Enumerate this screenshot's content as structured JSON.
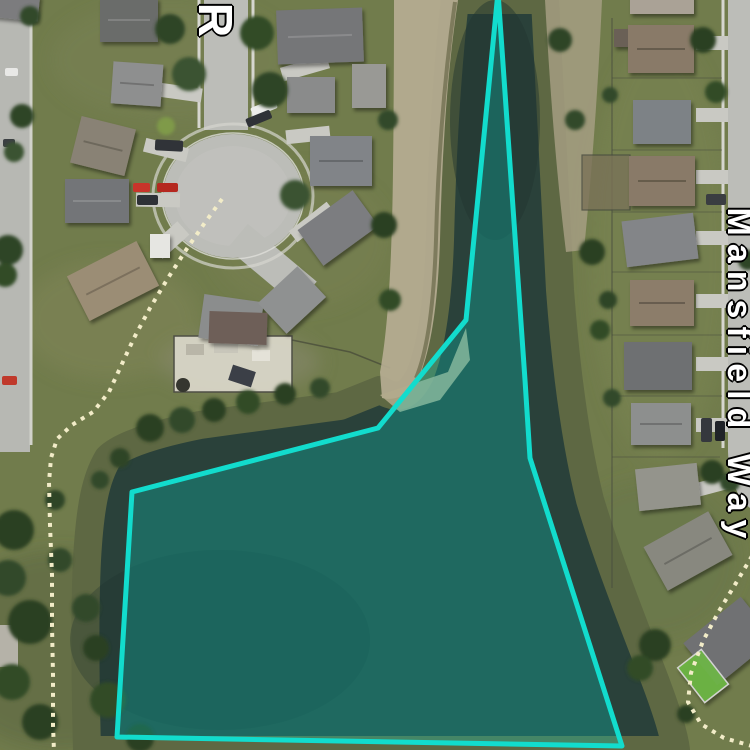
{
  "map": {
    "type": "satellite-imagery-with-annotation",
    "street_labels": {
      "top": "R",
      "right": "Mansfield Way"
    },
    "annotation": {
      "shape": "polygon",
      "description": "cyan water-parcel outline over pond",
      "points": [
        [
          498,
          -8
        ],
        [
          466,
          320
        ],
        [
          378,
          428
        ],
        [
          132,
          492
        ],
        [
          117,
          737
        ],
        [
          622,
          746
        ],
        [
          530,
          458
        ],
        [
          525,
          380
        ]
      ],
      "stroke": "#12dccd",
      "fill": "rgba(0,219,205,0.26)",
      "stroke_width": 5
    },
    "parcel_boundaries": {
      "style": "dashed",
      "color": "#f2ecc8",
      "width": 4,
      "dash": [
        4,
        6
      ],
      "paths": [
        [
          [
            222,
            199
          ],
          [
            204,
            224
          ],
          [
            186,
            250
          ],
          [
            168,
            278
          ],
          [
            150,
            308
          ],
          [
            134,
            338
          ],
          [
            121,
            366
          ],
          [
            109,
            392
          ],
          [
            93,
            412
          ],
          [
            72,
            425
          ],
          [
            57,
            439
          ],
          [
            51,
            458
          ],
          [
            49,
            482
          ],
          [
            50,
            525
          ],
          [
            52,
            575
          ],
          [
            52,
            625
          ],
          [
            53,
            675
          ],
          [
            53,
            725
          ],
          [
            54,
            752
          ]
        ],
        [
          [
            752,
            556
          ],
          [
            736,
            583
          ],
          [
            719,
            611
          ],
          [
            703,
            641
          ],
          [
            691,
            673
          ],
          [
            688,
            702
          ],
          [
            701,
            724
          ],
          [
            724,
            738
          ],
          [
            752,
            746
          ]
        ]
      ]
    },
    "palette": {
      "grass": "#717c4c",
      "water": "#2a413a",
      "shore_olive": "#5e6843",
      "shore_sand": "#b6ad92",
      "road": "#bcbdb8",
      "label_color": "#ffffff",
      "label_outline": "#000000"
    }
  }
}
